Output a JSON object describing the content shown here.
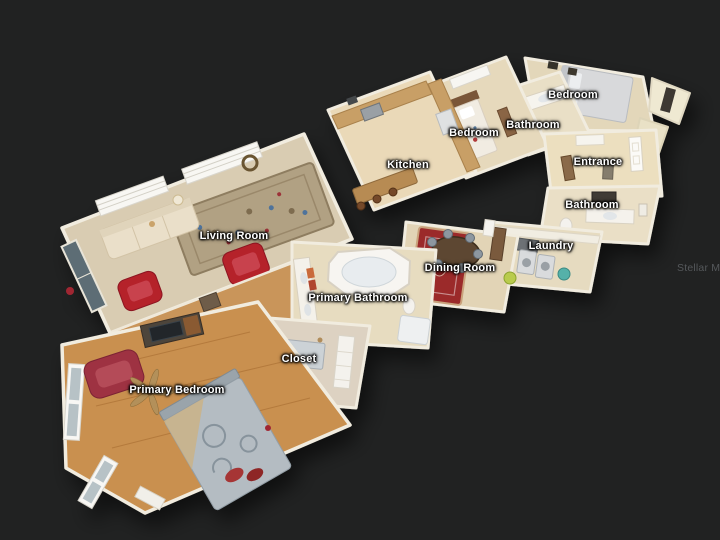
{
  "scene": {
    "watermark": "Stellar MLS",
    "background_color": "#212222",
    "colors": {
      "exterior_wall": "#f1ecdf",
      "tile_floor": "#e7dcc0",
      "wood_floor": "#c9904f",
      "accent_red_furniture": "#b5202b",
      "dining_rug_red": "#9b2b2b",
      "label_text": "#ffffff",
      "watermark_text": "#55585b"
    }
  },
  "labels": [
    {
      "id": "living-room",
      "text": "Living Room"
    },
    {
      "id": "kitchen",
      "text": "Kitchen"
    },
    {
      "id": "bedroom-1",
      "text": "Bedroom"
    },
    {
      "id": "bathroom-1",
      "text": "Bathroom"
    },
    {
      "id": "bedroom-2",
      "text": "Bedroom"
    },
    {
      "id": "entrance",
      "text": "Entrance"
    },
    {
      "id": "bathroom-2",
      "text": "Bathroom"
    },
    {
      "id": "laundry",
      "text": "Laundry"
    },
    {
      "id": "dining-room",
      "text": "Dining Room"
    },
    {
      "id": "primary-bathroom",
      "text": "Primary Bathroom"
    },
    {
      "id": "closet",
      "text": "Closet"
    },
    {
      "id": "primary-bedroom",
      "text": "Primary Bedroom"
    }
  ]
}
